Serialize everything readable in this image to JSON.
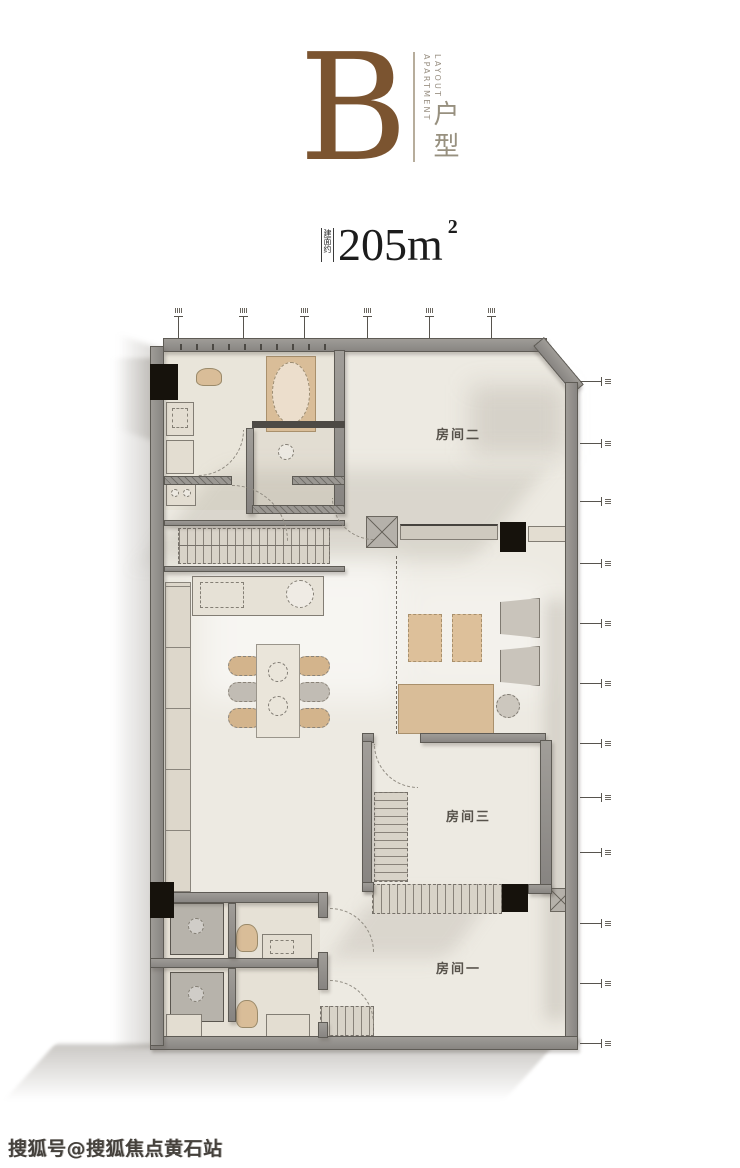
{
  "header": {
    "letter": "B",
    "letter_color": "#7b5430",
    "en_line1": "APARTMENT",
    "en_line2": "LAYOUT",
    "cn": "户型"
  },
  "area": {
    "prefix": "建面约",
    "value": "205m",
    "sup": "2"
  },
  "floorplan": {
    "rooms": [
      {
        "label": "房间二"
      },
      {
        "label": "房间三"
      },
      {
        "label": "房间一"
      }
    ],
    "colors": {
      "wall": "#8f8d89",
      "wall_edge": "#5e5b55",
      "floor": "#edeae2",
      "furniture_tan": "#d9bd98",
      "furniture_gray": "#c6c1b8",
      "column": "#16120c"
    },
    "top_tick_count": 6,
    "right_tick_count": 12
  },
  "watermark": {
    "text": "搜狐号@搜狐焦点黄石站"
  }
}
